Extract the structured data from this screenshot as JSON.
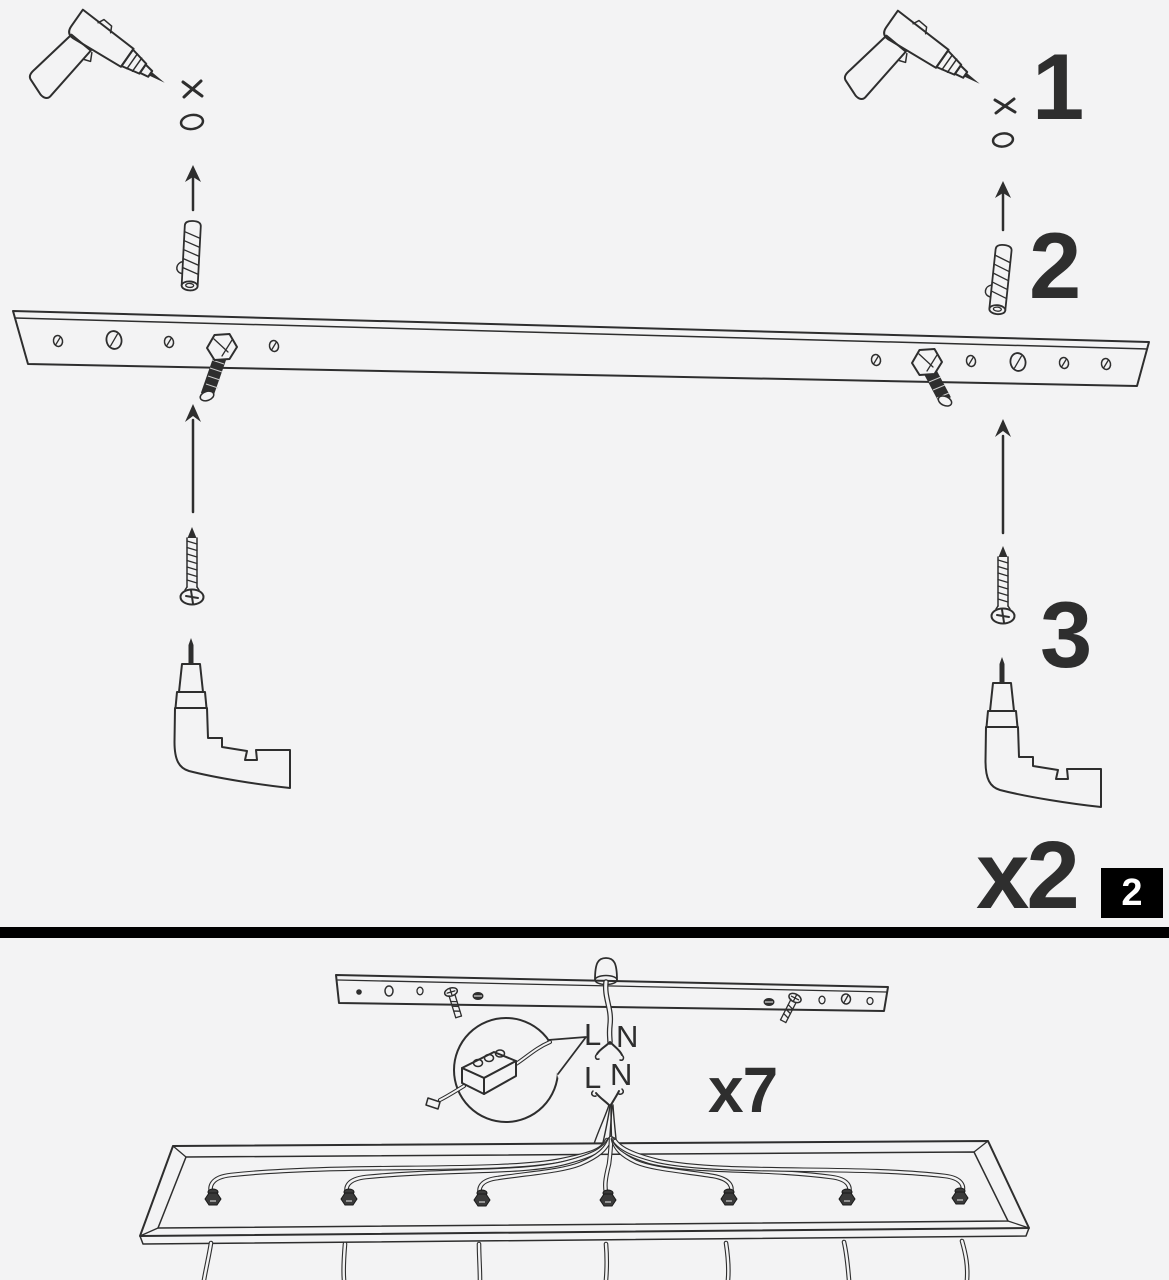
{
  "colors": {
    "background": "#f3f3f4",
    "ink": "#2e2e2e",
    "divider": "#000000",
    "badge_bg": "#000000",
    "badge_fg": "#ffffff"
  },
  "top_panel": {
    "step_numbers": [
      "1",
      "2",
      "3"
    ],
    "quantity_label": "x2",
    "page_badge": "2",
    "icons": [
      "drill-icon",
      "drill-mark-x-icon",
      "pilot-hole-icon",
      "arrow-up-icon",
      "wall-plug-icon",
      "mounting-bar-icon",
      "screw-hole-icon",
      "hex-bolt-icon",
      "screw-icon",
      "electric-screwdriver-icon"
    ]
  },
  "bottom_panel": {
    "quantity_label": "x7",
    "upper_wire_labels": [
      "L",
      "N"
    ],
    "lower_wire_labels": [
      "L",
      "N"
    ],
    "icons": [
      "mounting-bar-icon",
      "cable-grommet-icon",
      "supply-wire-icon",
      "terminal-block-icon",
      "callout-circle-icon",
      "wire-bundle-icon",
      "canopy-base-icon",
      "cable-gland-icon",
      "pendant-cable-icon"
    ]
  }
}
